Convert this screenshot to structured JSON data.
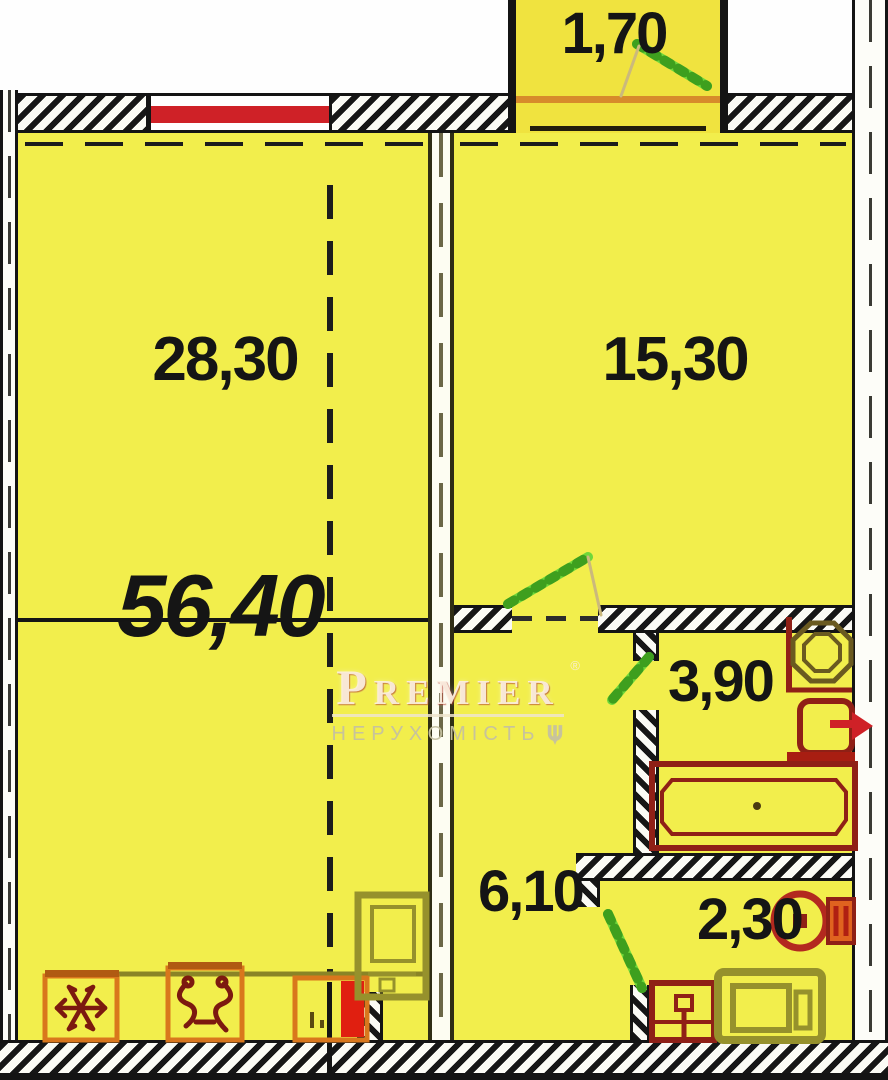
{
  "watermark": {
    "brand": "Premier",
    "subtitle": "НЕРУХОМІСТЬ",
    "trademark": "®"
  },
  "areas": {
    "balcony": "1,70",
    "living_kitchen": "28,30",
    "bedroom": "15,30",
    "total": "56,40",
    "bathroom": "3,90",
    "hallway": "6,10",
    "wc": "2,30"
  },
  "colors": {
    "room_fill": "#f2ee4c",
    "balcony_fill": "#f0e33f",
    "wall_black": "#141414",
    "window_red": "#cf2127",
    "fixture_dark_red": "#8f2016",
    "fixture_bright_red": "#e01f10",
    "appliance_orange": "#d9771c",
    "furniture_olive": "#96912c",
    "door_green": "#5ec930",
    "label_color": "#151515"
  }
}
